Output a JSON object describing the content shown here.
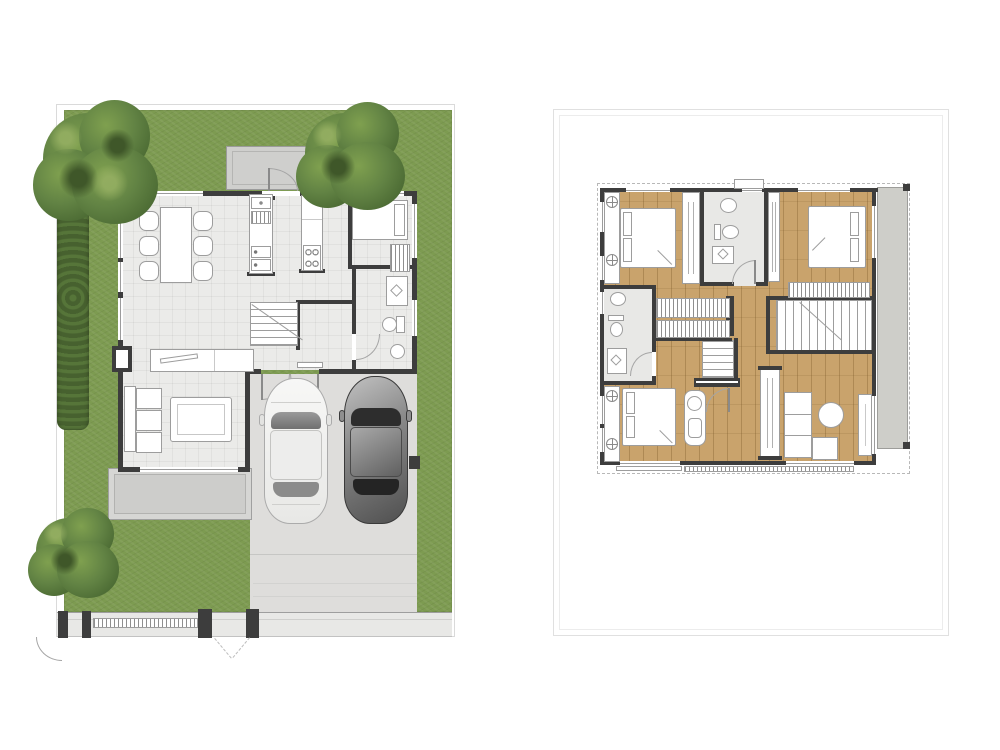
{
  "document": {
    "type": "architectural-floor-plan-rendering",
    "views": [
      {
        "id": "first-floor",
        "label": "First floor site plan with garden, porch and carport"
      },
      {
        "id": "second-floor",
        "label": "Second floor plan inside bordered card"
      }
    ]
  },
  "colors": {
    "wall": "#3d3d3d",
    "grass": "#7d9b51",
    "hedge": "#4c6832",
    "tile": "#ebebe9",
    "wood": "#c9a36c",
    "concrete": "#dedddb",
    "porch": "#d6d6d4",
    "patio": "#cfcfcd",
    "roof": "#cecec9",
    "fence": "#e8e8e6",
    "outline": "#9d9d9d",
    "cardborder": "#e0e0e0"
  },
  "first_floor": {
    "site": {
      "lawn": true,
      "trees": 3,
      "hedge_rows": 1,
      "front_fence": "wall with pedestrian gate and driveway crossing",
      "driveway": true
    },
    "rooms": [
      "dining area",
      "kitchen",
      "utility room",
      "bathroom",
      "stair hall",
      "living room",
      "porch",
      "rear patio",
      "carport"
    ],
    "furniture": {
      "dining": {
        "table": 1,
        "chairs": 6
      },
      "kitchen": {
        "counters": 2,
        "sink": 1,
        "stove_burners": 4,
        "drawers": 2
      },
      "utility": {
        "single_bed": 1,
        "shelf_rack": 1
      },
      "bathroom": {
        "shower_tray": 1,
        "toilet": 1,
        "wash_basin": 1
      },
      "living": {
        "sofa_cushions": 3,
        "coffee_table": 1,
        "tv_console": 1,
        "tv": 1
      },
      "stairs_treads": 7
    },
    "vehicles": [
      {
        "type": "sedan",
        "color_name": "white"
      },
      {
        "type": "sedan",
        "color_name": "dark-gray"
      }
    ]
  },
  "second_floor": {
    "rooms": [
      "bedroom-2 (top left)",
      "shared bathroom (top middle)",
      "bedroom-3 (top right)",
      "bathroom (middle left)",
      "hall with closets",
      "stairwell",
      "master bedroom (bottom left)",
      "family corner (bottom right)",
      "roof strip (right)"
    ],
    "furniture": {
      "beds": 3,
      "wardrobe_strips": 5,
      "closet_slats": 3,
      "vanity_desk": 1,
      "stool": 1,
      "sofa_cushions": 4,
      "round_table": 1,
      "tv_console": 1,
      "toilets": 2,
      "wash_basins": 2,
      "shower_trays": 2
    }
  }
}
